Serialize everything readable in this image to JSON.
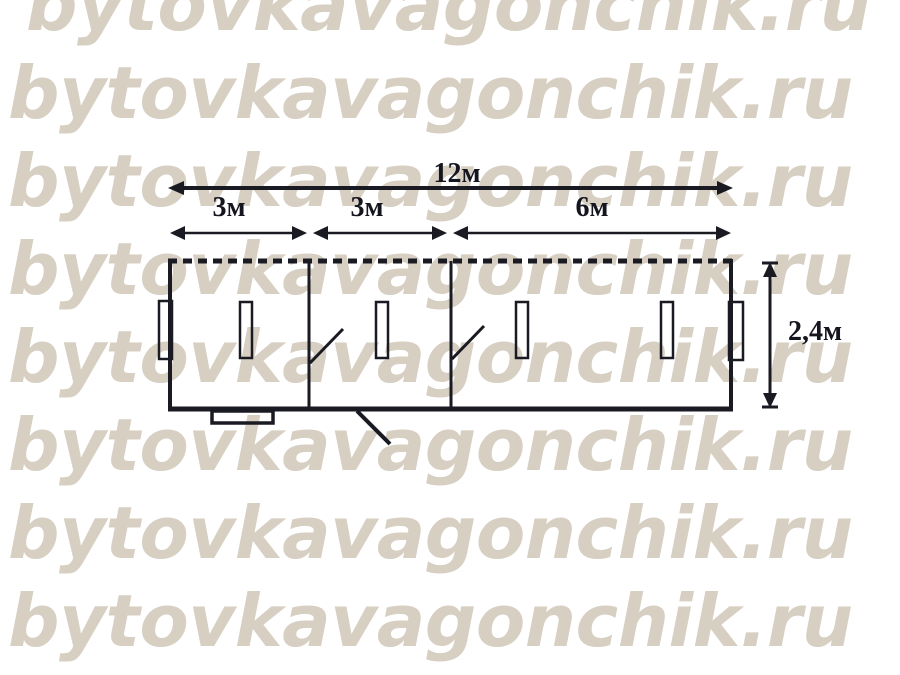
{
  "image": {
    "kind": "floor-plan drawing",
    "background_color": "#ffffff"
  },
  "watermark": {
    "text": "bytovkavagonchik.ru",
    "color": "#d6cfc2",
    "rows": 8
  },
  "plan": {
    "ink_color": "#1a1a22",
    "dimensions": {
      "total_length": "12м",
      "section_1_width": "3м",
      "section_2_width": "3м",
      "section_3_width": "6м",
      "height": "2,4м"
    }
  }
}
